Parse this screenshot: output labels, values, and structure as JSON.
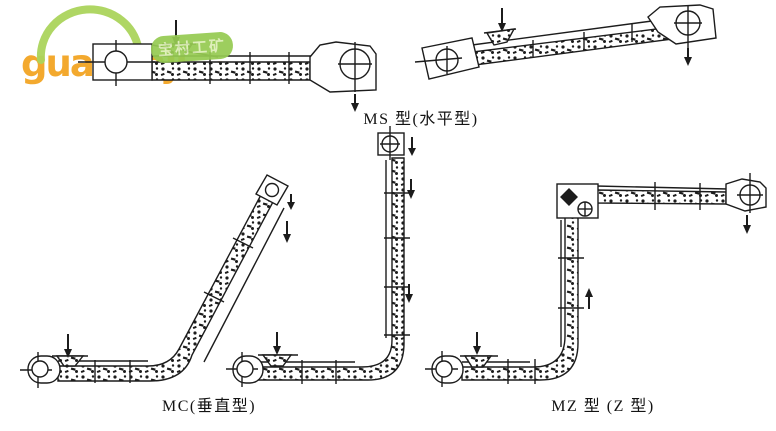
{
  "page": {
    "background": "#ffffff",
    "ink": "#1c1c1c"
  },
  "watermark": {
    "brand": "guabanji",
    "tld": ".net",
    "badge_text": "宝村工矿",
    "arc_color": "#abd45c",
    "text_color": "#f2a21d",
    "badge_bg": "#96cb52",
    "badge_text_color": "#dceeb6"
  },
  "figures": {
    "ms": {
      "caption": "MS 型(水平型)"
    },
    "mc": {
      "caption": "MC(垂直型)"
    },
    "mz": {
      "caption": "MZ 型 (Z 型)"
    }
  }
}
